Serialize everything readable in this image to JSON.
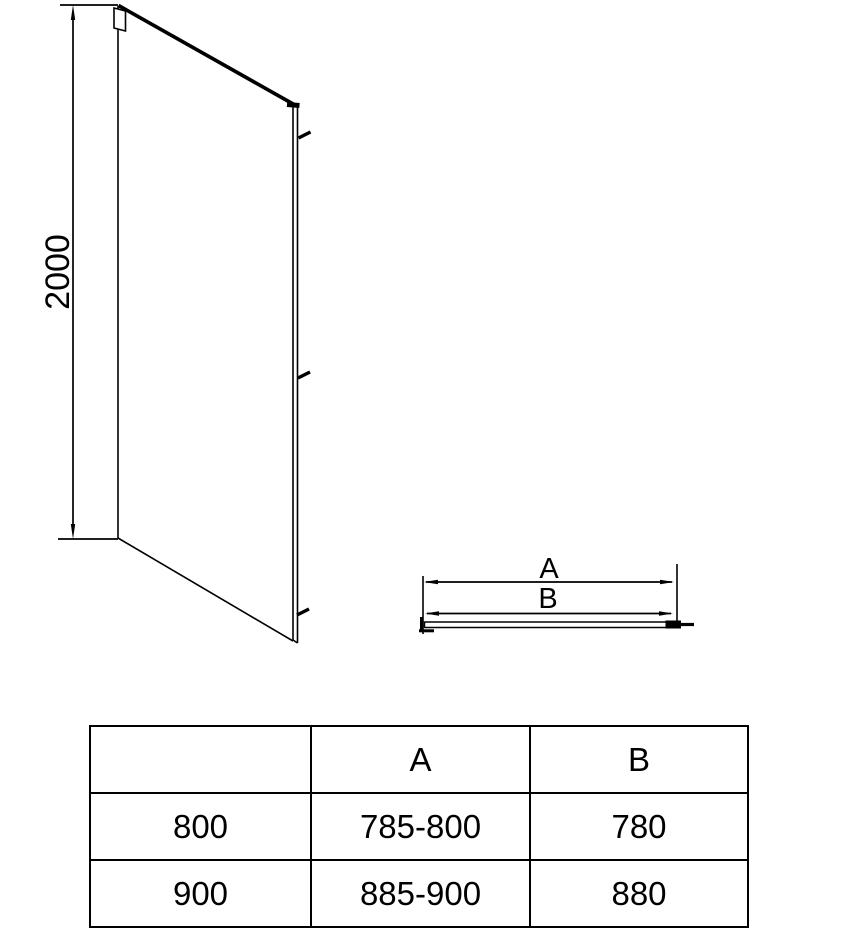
{
  "figure": {
    "side_view": {
      "height_dimension": "2000"
    },
    "top_view": {
      "dim_a_label": "A",
      "dim_b_label": "B"
    }
  },
  "size_table": {
    "headers": [
      "",
      "A",
      "B"
    ],
    "rows": [
      [
        "800",
        "785-800",
        "780"
      ],
      [
        "900",
        "885-900",
        "880"
      ]
    ]
  },
  "colors": {
    "line": "#000000",
    "background": "#ffffff"
  }
}
